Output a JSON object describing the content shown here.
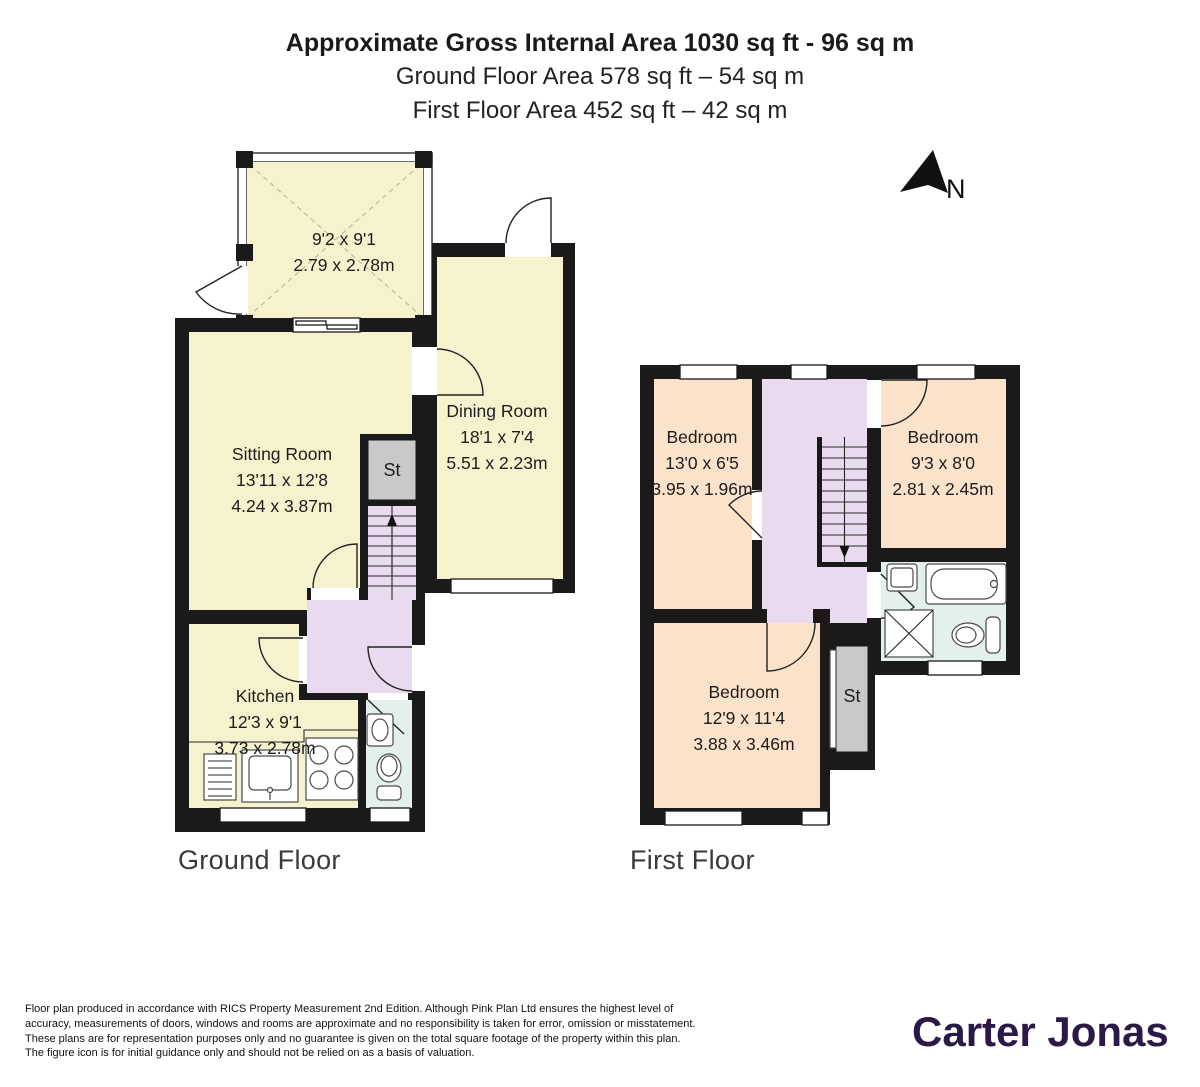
{
  "header": {
    "line1": "Approximate Gross Internal Area 1030 sq ft - 96 sq m",
    "line2": "Ground Floor Area 578 sq ft – 54 sq m",
    "line3": "First Floor Area 452 sq ft – 42 sq m"
  },
  "north_indicator": {
    "label": "N"
  },
  "ground_floor": {
    "caption": "Ground Floor",
    "rooms": {
      "conservatory": {
        "dims_ft": "9'2 x 9'1",
        "dims_m": "2.79 x 2.78m"
      },
      "sitting_room": {
        "name": "Sitting Room",
        "dims_ft": "13'11 x 12'8",
        "dims_m": "4.24 x 3.87m"
      },
      "dining_room": {
        "name": "Dining Room",
        "dims_ft": "18'1 x 7'4",
        "dims_m": "5.51 x 2.23m"
      },
      "kitchen": {
        "name": "Kitchen",
        "dims_ft": "12'3 x 9'1",
        "dims_m": "3.73 x 2.78m"
      },
      "store": {
        "name": "St"
      }
    }
  },
  "first_floor": {
    "caption": "First Floor",
    "rooms": {
      "bedroom_left": {
        "name": "Bedroom",
        "dims_ft": "13'0 x 6'5",
        "dims_m": "3.95 x 1.96m"
      },
      "bedroom_right": {
        "name": "Bedroom",
        "dims_ft": "9'3 x 8'0",
        "dims_m": "2.81 x 2.45m"
      },
      "bedroom_bottom": {
        "name": "Bedroom",
        "dims_ft": "12'9 x 11'4",
        "dims_m": "3.88 x 3.46m"
      },
      "store": {
        "name": "St"
      }
    }
  },
  "footer": {
    "disclaimer": "Floor plan produced in accordance with RICS Property Measurement 2nd Edition. Although Pink Plan Ltd ensures the highest level of accuracy, measurements of doors, windows and rooms are approximate and no responsibility is taken for error, omission or misstatement. These plans are for representation purposes only and no guarantee is given on the total square footage of the property within this plan. The figure icon is for initial guidance only and should not be relied on as a basis of valuation.",
    "brand": "Carter Jonas"
  },
  "colors": {
    "wall_black": "#1a1a1a",
    "room_cream": "#f7f2ce",
    "room_peach": "#fbe3cb",
    "hall_lilac": "#eadaef",
    "bathroom_blue": "#e3f0ec",
    "store_grey": "#c9c9c9",
    "brand_purple": "#2b1948"
  }
}
